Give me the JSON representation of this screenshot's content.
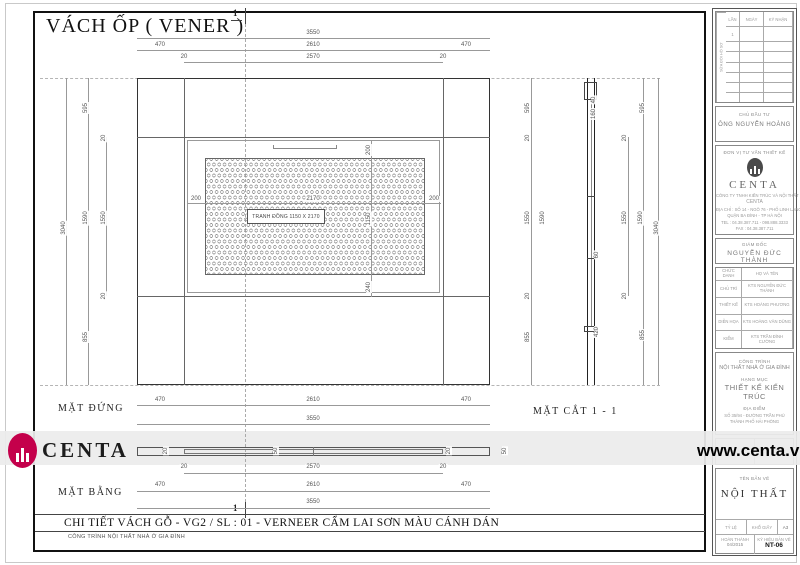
{
  "title": "VÁCH ỐP ( VENER )",
  "views": {
    "elevation_label": "MẶT ĐỨNG",
    "section_label": "MẶT CẮT 1 - 1",
    "plan_label": "MẶT BẰNG",
    "section_marker": "1"
  },
  "picture_label": "TRANH ĐỒNG 1150 X 2170",
  "footer": {
    "detail_title": "CHI TIẾT VÁCH GỖ - VG2 / SL : 01 - VERNEER CẨM LAI SƠN MÀU CÁNH DÁN",
    "project_line": "CÔNG TRÌNH NỘI THẤT NHÀ Ở GIA ĐÌNH"
  },
  "watermark": {
    "brand": "CENTA",
    "site": "www.centa.vn",
    "logo_color": "#c4004b"
  },
  "dim_labels": [
    {
      "t": "3550",
      "x": 313,
      "y": 33
    },
    {
      "t": "470",
      "x": 160,
      "y": 45
    },
    {
      "t": "2610",
      "x": 313,
      "y": 45
    },
    {
      "t": "470",
      "x": 466,
      "y": 45
    },
    {
      "t": "20",
      "x": 184,
      "y": 57
    },
    {
      "t": "2570",
      "x": 313,
      "y": 57
    },
    {
      "t": "20",
      "x": 443,
      "y": 57
    },
    {
      "t": "470",
      "x": 160,
      "y": 400
    },
    {
      "t": "2610",
      "x": 313,
      "y": 400
    },
    {
      "t": "470",
      "x": 466,
      "y": 400
    },
    {
      "t": "3550",
      "x": 313,
      "y": 419
    },
    {
      "t": "20",
      "x": 184,
      "y": 467
    },
    {
      "t": "2570",
      "x": 313,
      "y": 467
    },
    {
      "t": "20",
      "x": 443,
      "y": 467
    },
    {
      "t": "470",
      "x": 160,
      "y": 485
    },
    {
      "t": "2610",
      "x": 313,
      "y": 485
    },
    {
      "t": "470",
      "x": 466,
      "y": 485
    },
    {
      "t": "3550",
      "x": 313,
      "y": 502
    },
    {
      "t": "3040",
      "x": 64,
      "y": 228,
      "r": 1
    },
    {
      "t": "595",
      "x": 86,
      "y": 108,
      "r": 1
    },
    {
      "t": "1590",
      "x": 86,
      "y": 218,
      "r": 1
    },
    {
      "t": "855",
      "x": 86,
      "y": 337,
      "r": 1
    },
    {
      "t": "20",
      "x": 104,
      "y": 138,
      "r": 1
    },
    {
      "t": "1550",
      "x": 104,
      "y": 218,
      "r": 1
    },
    {
      "t": "20",
      "x": 104,
      "y": 296,
      "r": 1
    },
    {
      "t": "200",
      "x": 196,
      "y": 199
    },
    {
      "t": "2170",
      "x": 313,
      "y": 199
    },
    {
      "t": "200",
      "x": 434,
      "y": 199
    },
    {
      "t": "200",
      "x": 369,
      "y": 150,
      "r": 1
    },
    {
      "t": "1150",
      "x": 369,
      "y": 219,
      "r": 1
    },
    {
      "t": "240",
      "x": 369,
      "y": 287,
      "r": 1
    },
    {
      "t": "595",
      "x": 528,
      "y": 108,
      "r": 1
    },
    {
      "t": "20",
      "x": 528,
      "y": 138,
      "r": 1
    },
    {
      "t": "1550",
      "x": 528,
      "y": 218,
      "r": 1
    },
    {
      "t": "20",
      "x": 528,
      "y": 296,
      "r": 1
    },
    {
      "t": "855",
      "x": 528,
      "y": 337,
      "r": 1
    },
    {
      "t": "1590",
      "x": 543,
      "y": 218,
      "r": 1
    },
    {
      "t": "20",
      "x": 625,
      "y": 138,
      "r": 1
    },
    {
      "t": "1550",
      "x": 625,
      "y": 218,
      "r": 1
    },
    {
      "t": "20",
      "x": 625,
      "y": 296,
      "r": 1
    },
    {
      "t": "595",
      "x": 643,
      "y": 108,
      "r": 1
    },
    {
      "t": "855",
      "x": 643,
      "y": 335,
      "r": 1
    },
    {
      "t": "1590",
      "x": 641,
      "y": 218,
      "r": 1
    },
    {
      "t": "3040",
      "x": 657,
      "y": 228,
      "r": 1
    },
    {
      "t": "40",
      "x": 594,
      "y": 100,
      "r": 1
    },
    {
      "t": "160",
      "x": 594,
      "y": 114,
      "r": 1
    },
    {
      "t": "60",
      "x": 597,
      "y": 255,
      "r": 1
    },
    {
      "t": "420",
      "x": 597,
      "y": 332,
      "r": 1
    },
    {
      "t": "20",
      "x": 166,
      "y": 451,
      "r": 1
    },
    {
      "t": "50",
      "x": 276,
      "y": 451,
      "r": 1
    },
    {
      "t": "20",
      "x": 449,
      "y": 451,
      "r": 1
    },
    {
      "t": "50",
      "x": 505,
      "y": 451,
      "r": 1
    }
  ],
  "sidebar": {
    "revisions": {
      "col_vertical": "SỬA ĐỔI HỒ SƠ",
      "headers": [
        "LẦN",
        "NGÀY",
        "KÝ NHẬN"
      ],
      "first_row_no": "1"
    },
    "owner": {
      "label": "CHỦ ĐẦU TƯ",
      "name": "ÔNG NGUYỄN HOÀNG"
    },
    "firm": {
      "label": "ĐƠN VỊ TƯ VẤN THIẾT KẾ",
      "brand": "CENTA",
      "company": "CÔNG TY TNHH KIẾN TRÚC VÀ NỘI THẤT",
      "company2": "CENTA",
      "addr1": "ĐỊA CHỈ : SỐ 14 - NGÕ 76 - PHỐ LINH LANG",
      "addr2": "QUẬN BA ĐÌNH - TP HÀ NỘI",
      "addr3": "TEL : 04.38.387.711 - 098.888.3333",
      "addr4": "FAX : 04.38.387.711"
    },
    "director": {
      "label": "GIÁM ĐỐC",
      "name": "NGUYỄN ĐỨC THÀNH"
    },
    "people": {
      "headers": [
        "CHỨC DANH",
        "HỌ VÀ TÊN"
      ],
      "rows": [
        {
          "role": "CHỦ TRÌ",
          "name": "KTS NGUYỄN ĐỨC THÀNH"
        },
        {
          "role": "THIẾT KẾ",
          "name": "KTS HOÀNG PHƯƠNG"
        },
        {
          "role": "DIỄN HỌA",
          "name": "KTS HOÀNG VĂN DŨNG"
        },
        {
          "role": "KIỂM",
          "name": "KTS TRẦN ĐÌNH CƯỜNG"
        }
      ]
    },
    "project": {
      "label1": "CÔNG TRÌNH",
      "value1": "NỘI THẤT NHÀ Ở GIA ĐÌNH",
      "label2": "HẠNG MỤC",
      "value2": "THIẾT KẾ KIẾN TRÚC",
      "label3": "ĐỊA ĐIỂM",
      "value3": "SỐ 35/94 - ĐƯỜNG TRẦN PHÚ",
      "value4": "THÀNH PHỐ HẢI PHÒNG"
    },
    "stage": {
      "left": "GIAI ĐOẠN THIẾT KẾ",
      "right": "HỒ SƠ KỸ THUẬT"
    },
    "drawing": {
      "label": "TÊN BẢN VẼ",
      "name": "NỘI THẤT",
      "scale_label": "TỶ LỆ",
      "paper_label": "KHỔ GIẤY",
      "paper": "A3",
      "done_label": "HOÀN THÀNH",
      "done": "04/2015",
      "code_label": "KÝ HIỆU BẢN VẼ",
      "code": "NT-06"
    }
  }
}
